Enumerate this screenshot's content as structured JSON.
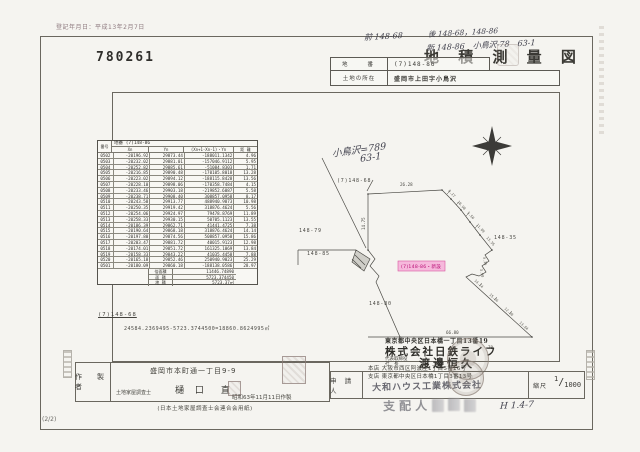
{
  "stamp_date": "登記年月日：平成13年2月7日",
  "doc_number": "780261",
  "page_number": "(2/2)",
  "title": "地 積 測 量 図",
  "annotations": {
    "prev": "前 148-68",
    "after": "後 148-68，148-86",
    "new": "新 148-86　小鳥沢-78　63-1",
    "map_note_1": "小鳥沢=789",
    "map_note_2": "63-1",
    "approval": "H 1.4-7"
  },
  "header_table": {
    "lot_label": "地　　番",
    "lot_value": "(7)148-86",
    "location_label": "土地の所在",
    "location_value": "盛岡市上田字小鳥沢"
  },
  "coord_table": {
    "no_label": "番号",
    "caption": "地番 (7)148-86",
    "columns": [
      "Xn",
      "Yn",
      "(Xn+1-Xn-1)・Yn",
      "距 離"
    ],
    "rows": [
      [
        "0502",
        "-20196.92",
        "29873.44",
        "-188011.1342",
        "4.96"
      ],
      [
        "0503",
        "-20232.02",
        "29881.01",
        "-157046.9112",
        "5.95"
      ],
      [
        "0504",
        "-20252.82",
        "29885.61",
        "-51084.8303",
        "1.71"
      ],
      [
        "0505",
        "-20216.85",
        "29890.48",
        "-170105.8018",
        "13.28"
      ],
      [
        "0506",
        "-20223.02",
        "29894.12",
        "-188115.8428",
        "13.56"
      ],
      [
        "0507",
        "-20228.10",
        "29898.06",
        "-170358.7484",
        "4.15"
      ],
      [
        "0508",
        "-20233.46",
        "29903.18",
        "-219852.6087",
        "5.58"
      ],
      [
        "0509",
        "-20238.71",
        "29908.40",
        "308857.0958",
        "8.17"
      ],
      [
        "0510",
        "-20243.58",
        "29913.77",
        "488940.9873",
        "10.98"
      ],
      [
        "0511",
        "-20250.35",
        "29919.42",
        "318876.4624",
        "5.56"
      ],
      [
        "0512",
        "-20254.06",
        "29924.97",
        "79478.8769",
        "11.89"
      ],
      [
        "0513",
        "-20258.33",
        "29930.15",
        "50705.1123",
        "13.55"
      ],
      [
        "0514",
        "-20186.39",
        "29862.71",
        "41441.4725",
        "7.38"
      ],
      [
        "0515",
        "-20190.64",
        "29868.18",
        "318876.4624",
        "14.14"
      ],
      [
        "0516",
        "-20197.80",
        "29874.56",
        "508857.0958",
        "15.86"
      ],
      [
        "0517",
        "-20203.47",
        "29881.72",
        "40015.9123",
        "12.98"
      ],
      [
        "0518",
        "-20174.01",
        "29851.72",
        "161325.1069",
        "13.84"
      ],
      [
        "0519",
        "-20158.33",
        "29843.22",
        "41035.4458",
        "7.88"
      ],
      [
        "0520",
        "-20165.18",
        "29852.46",
        "250940.9023",
        "25.29"
      ],
      [
        "0501",
        "-20180.09",
        "29860.18",
        "-188138.0586",
        "28.97"
      ]
    ],
    "summary": [
      [
        "倍面積",
        "11446.74890"
      ],
      [
        "面 積",
        "5723.374450"
      ],
      [
        "地 積",
        "5723.37㎡"
      ]
    ]
  },
  "remainder": {
    "lot": "(7)148-68",
    "calc": "24584.2369495-5723.3744500=18860.8624995㎡"
  },
  "map": {
    "highlight": "(7)148-86・新設",
    "labels": [
      {
        "text": "(7)148-68",
        "x": 57,
        "y": 64,
        "cls": "lot",
        "name": "lot-label-148-68"
      },
      {
        "text": "148-79",
        "x": 19,
        "y": 114,
        "cls": "lot",
        "name": "lot-label-148-79"
      },
      {
        "text": "148-85",
        "x": 27,
        "y": 137,
        "cls": "lot",
        "name": "lot-label-148-85"
      },
      {
        "text": "148-80",
        "x": 89,
        "y": 187,
        "cls": "lot",
        "name": "lot-label-148-80"
      },
      {
        "text": "148-35",
        "x": 214,
        "y": 121,
        "cls": "lot",
        "name": "lot-label-148-35"
      },
      {
        "text": "26.28",
        "x": 120,
        "y": 68,
        "cls": "dim",
        "name": "dim-26-28"
      },
      {
        "text": "14.75",
        "x": 85,
        "y": 112,
        "cls": "dim",
        "rot": -90,
        "name": "dim-14-75"
      },
      {
        "text": "66.80",
        "x": 166,
        "y": 216,
        "cls": "dim",
        "name": "dim-66-80"
      },
      {
        "text": "70",
        "x": 208,
        "y": 231,
        "cls": "dim",
        "name": "dim-70"
      }
    ],
    "segments": [
      {
        "text": "8.17",
        "x": 168,
        "y": 73,
        "rot": 48
      },
      {
        "text": "10.98",
        "x": 177,
        "y": 84,
        "rot": 48
      },
      {
        "text": "5.56",
        "x": 187,
        "y": 95,
        "rot": 48
      },
      {
        "text": "11.89",
        "x": 196,
        "y": 107,
        "rot": 48
      },
      {
        "text": "13.55",
        "x": 206,
        "y": 120,
        "rot": 48
      },
      {
        "text": "4.35",
        "x": 203,
        "y": 139,
        "rot": 80
      },
      {
        "text": "3.90",
        "x": 200,
        "y": 151,
        "rot": 80
      },
      {
        "text": "14.14",
        "x": 194,
        "y": 163,
        "rot": 42
      },
      {
        "text": "15.86",
        "x": 209,
        "y": 177,
        "rot": 42
      },
      {
        "text": "12.98",
        "x": 224,
        "y": 191,
        "rot": 42
      },
      {
        "text": "13.84",
        "x": 239,
        "y": 205,
        "rot": 42
      }
    ]
  },
  "owner": {
    "address": "東京都中央区日本橋一丁目13番19",
    "company": "株式会社日鉄ライフ",
    "role_line1": "代表取締役",
    "role_line2": "社　長",
    "name": "渡邊恒久"
  },
  "maker": {
    "label": "作　製　者",
    "qualification": "土地家屋調査士",
    "office": "盛岡市本町通一丁目9-9",
    "name": "樋 口　直",
    "date": "昭和63年11月11日作製",
    "paper": "(日本土地家屋調査士会連合会用紙)"
  },
  "applicant": {
    "label": "申 請 人",
    "line1": "本店 大阪市西区阿波座1丁目5番16号",
    "line2": "支店 東京都中央区日本橋1丁目3番13号",
    "company": "大和ハウス工業株式会社",
    "manager": "支配人",
    "scale_label": "縮尺",
    "scale_num": "1",
    "scale_den": "1000"
  }
}
